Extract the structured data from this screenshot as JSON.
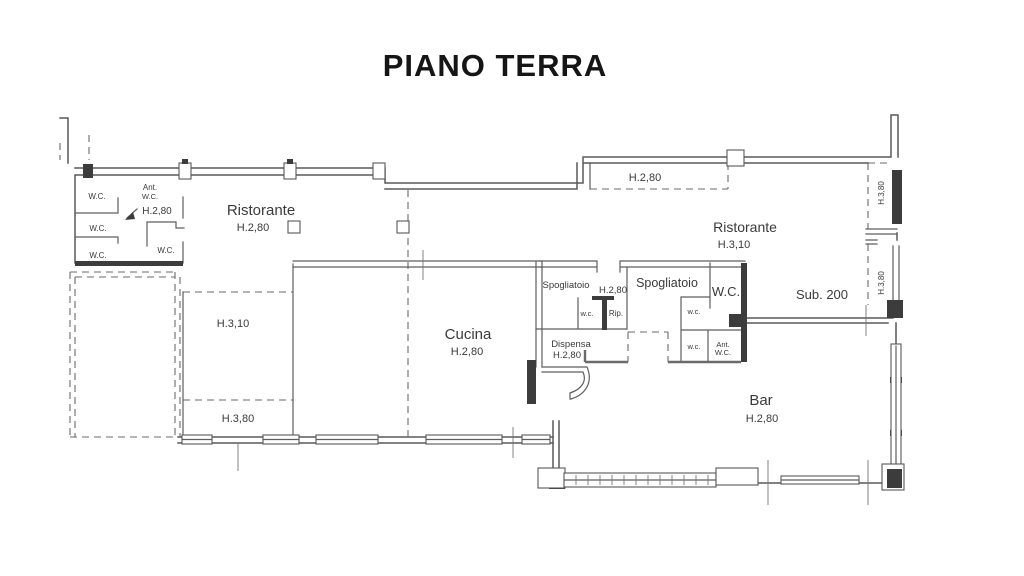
{
  "title": "PIANO TERRA",
  "plan": {
    "wc_cluster": {
      "wc1": "W.C.",
      "ant_line1": "Ant.",
      "ant_line2": "W.C.",
      "height": "H.2,80",
      "wc2": "W.C.",
      "wc3": "W.C.",
      "wc4": "W.C."
    },
    "ristorante_left": {
      "name": "Ristorante",
      "height": "H.2,80"
    },
    "zone_left": {
      "h310": "H.3,10",
      "h380": "H.3,80"
    },
    "cucina": {
      "name": "Cucina",
      "height": "H.2,80"
    },
    "spogliatoio_small": {
      "name": "Spogliatoio",
      "height": "H.2,80"
    },
    "service": {
      "wc_small": "w.c.",
      "rip": "Rip."
    },
    "dispensa": {
      "name": "Dispensa",
      "height": "H.2,80"
    },
    "spogliatoio_big": {
      "name": "Spogliatoio"
    },
    "wc_main": {
      "name": "W.C."
    },
    "wc_right_upper": "w.c.",
    "wc_right_lower": "w.c.",
    "ant_wc_right": {
      "line1": "Ant.",
      "line2": "W.C."
    },
    "zone_top_right": {
      "height": "H.2,80"
    },
    "ristorante_right": {
      "name": "Ristorante",
      "height": "H.3,10"
    },
    "sub": {
      "name": "Sub. 200"
    },
    "niche_upper": {
      "height": "H.3,80"
    },
    "niche_lower": {
      "height": "H.3,80"
    },
    "bar": {
      "name": "Bar",
      "height": "H.2,80"
    }
  }
}
